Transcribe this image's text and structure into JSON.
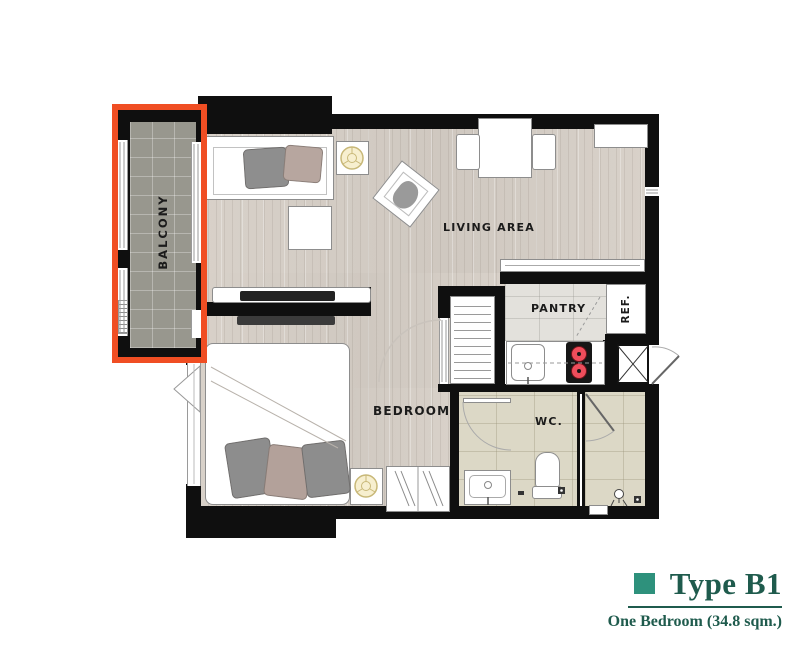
{
  "rooms": {
    "balcony": "BALCONY",
    "living": "LIVING AREA",
    "pantry": "PANTRY",
    "fridge": "REF.",
    "bedroom": "BEDROOM",
    "wc": "WC."
  },
  "legend": {
    "title": "Type B1",
    "subtitle": "One Bedroom (34.8 sqm.)",
    "swatch_color": "#2e917c",
    "text_color": "#1f5b4d"
  },
  "highlight": {
    "room": "BALCONY",
    "color": "#f04e23"
  }
}
